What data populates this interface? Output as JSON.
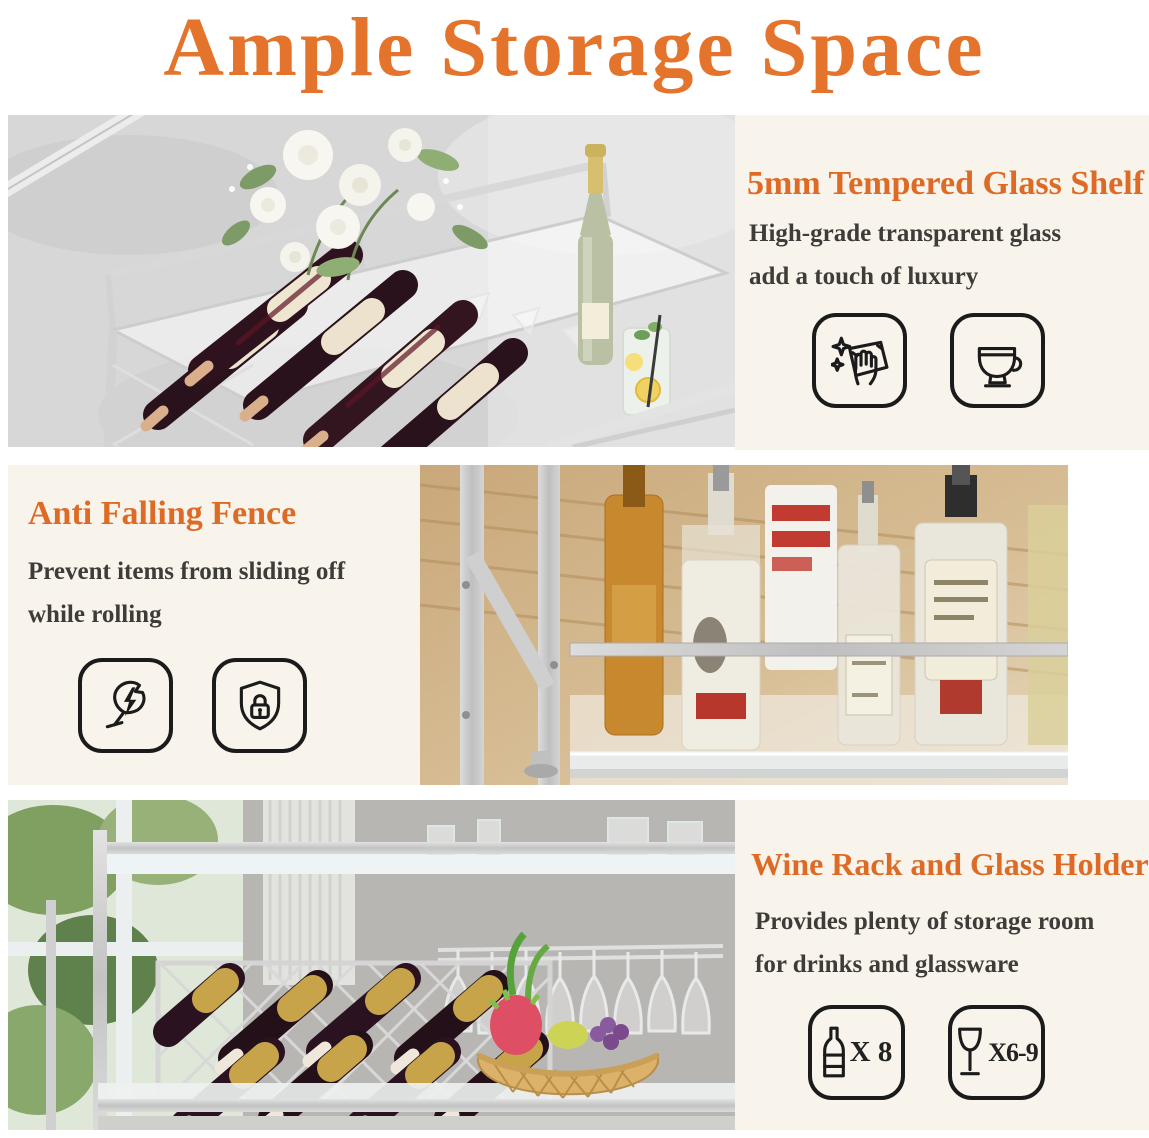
{
  "title": "Ample Storage Space",
  "colors": {
    "accent_orange": "#E4732C",
    "heading_orange": "#DD6B26",
    "body_text": "#3E3C39",
    "panel_background": "#F8F4EC",
    "page_background": "#FFFFFF",
    "icon_line": "#1B1B1B",
    "silver_frame": "#CFCFCF"
  },
  "sections": [
    {
      "id": "tempered-glass-shelf",
      "heading": "5mm Tempered Glass Shelf",
      "lines": [
        "High-grade transparent glass",
        "add a touch of luxury"
      ],
      "photo": "bar-cart-glass-top-with-white-roses-wine-bottles-champagne-and-lemon-drink",
      "icons": [
        {
          "name": "easy-wipe-clean-icon"
        },
        {
          "name": "coffee-cup-icon"
        }
      ]
    },
    {
      "id": "anti-falling-fence",
      "heading": "Anti Falling Fence",
      "lines": [
        "Prevent items from sliding off",
        "while rolling"
      ],
      "photo": "cart-fence-rail-holding-liquor-bottles-on-shelf",
      "icons": [
        {
          "name": "no-breakage-wine-glass-icon"
        },
        {
          "name": "security-shield-lock-icon"
        }
      ]
    },
    {
      "id": "wine-rack-and-glass-holder",
      "heading": "Wine Rack and Glass Holder",
      "lines": [
        "Provides plenty of storage room",
        "for drinks and glassware"
      ],
      "photo": "lattice-wine-rack-hanging-stemware-and-fruit-basket",
      "icons": [
        {
          "name": "wine-bottle-icon",
          "label": "X 8"
        },
        {
          "name": "wine-glass-icon",
          "label": "X6-9"
        }
      ]
    }
  ]
}
